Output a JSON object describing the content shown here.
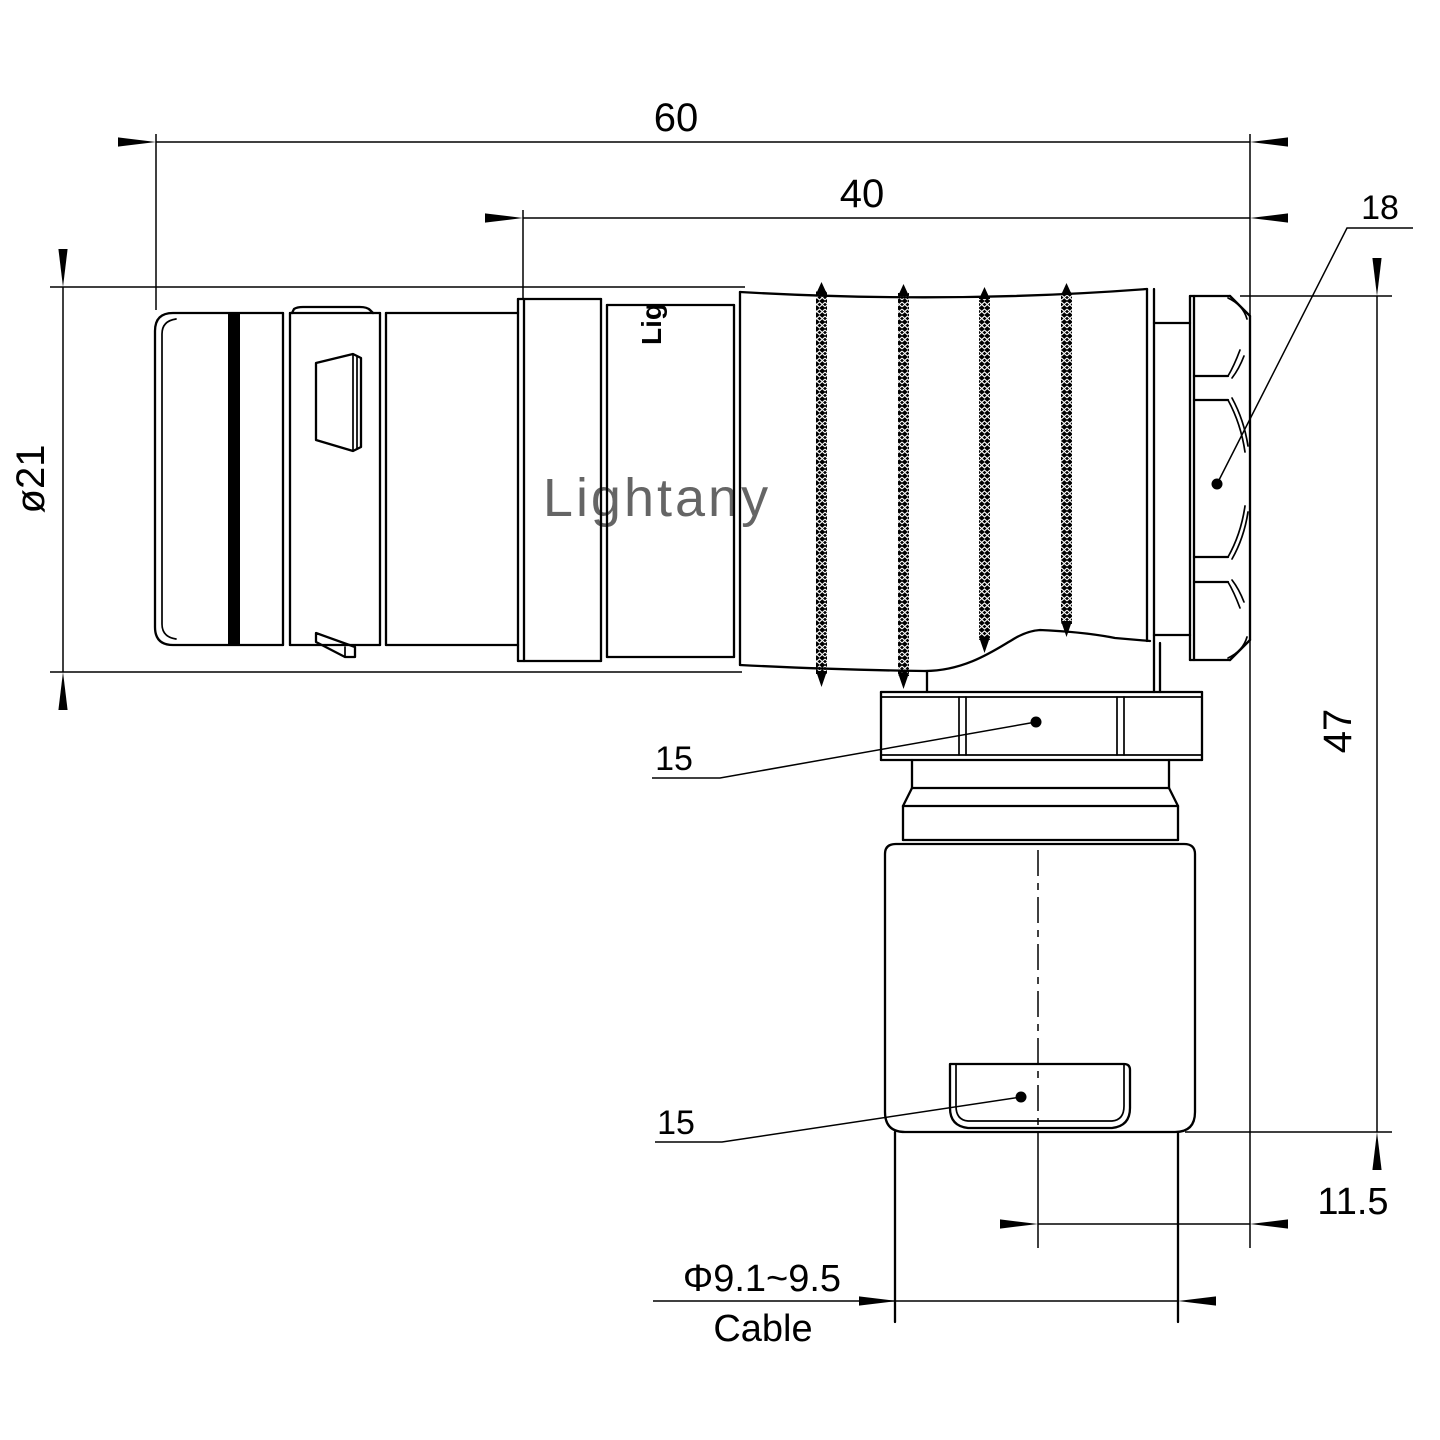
{
  "drawing": {
    "watermark": "Lightany",
    "brand_mark": "Lig",
    "dimensions": {
      "overall_length": "60",
      "front_length": "40",
      "coupling_nut_af": "18",
      "shell_diameter": "ø21",
      "overall_height": "47",
      "gland_nut_af": "15",
      "crimp_body_af": "15",
      "cable_axis_offset": "11.5",
      "cable_diameter": "Φ9.1~9.5",
      "cable_label": "Cable"
    },
    "colors": {
      "line": "#000000",
      "watermark": "#f2c3c3",
      "background": "#ffffff"
    }
  }
}
